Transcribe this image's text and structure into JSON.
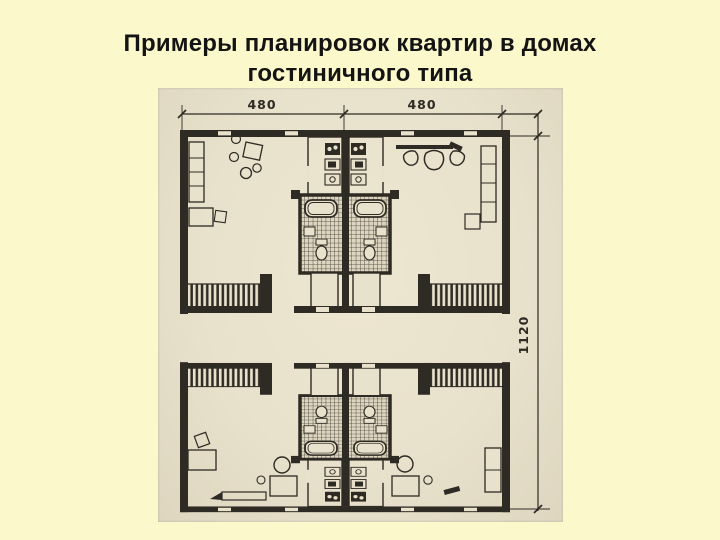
{
  "slide": {
    "background_color": "#fbf8cb",
    "title_color": "#141414",
    "title_lines": [
      "Примеры планировок квартир в домах",
      "гостиничного типа"
    ]
  },
  "figure": {
    "paper_color": "#e8e1cb",
    "ink_color": "#2e2a24",
    "dimension_labels": {
      "top_left_width": "480",
      "top_right_width": "480",
      "right_height": "1120"
    }
  }
}
